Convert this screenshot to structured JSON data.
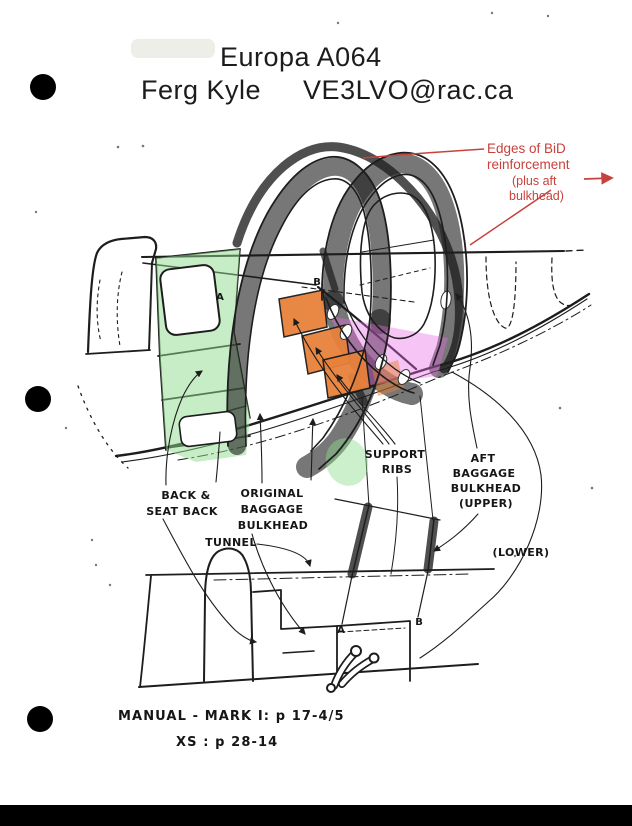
{
  "header": {
    "title": "Europa A064",
    "author": "Ferg Kyle",
    "email": "VE3LVO@rac.ca"
  },
  "red_note": {
    "l1": "Edges of BiD",
    "l2": "reinforcement",
    "l3": "(plus aft",
    "l4": "bulkhead)"
  },
  "labels": {
    "back_seat": {
      "l1": "BACK &",
      "l2": "SEAT BACK"
    },
    "original_baggage": {
      "l1": "ORIGINAL",
      "l2": "BAGGAGE",
      "l3": "BULKHEAD"
    },
    "tunnel": "TUNNEL",
    "support_ribs": {
      "l1": "SUPPORT",
      "l2": "RIBS"
    },
    "aft_baggage": {
      "l1": "AFT",
      "l2": "BAGGAGE",
      "l3": "BULKHEAD",
      "l4": "(UPPER)"
    },
    "lower": "(LOWER)",
    "markers": {
      "a_top": "A",
      "b_top": "B",
      "a_bottom": "A",
      "b_bottom": "B"
    }
  },
  "footer": {
    "l1": "MANUAL - MARK I:   p 17-4/5",
    "l2": "XS   :   p 28-14"
  },
  "colors": {
    "bid_red_highlight": "#d94f45",
    "red_annotation_text": "#c7423c",
    "green_highlight": "#8fdc8f",
    "magenta_highlight": "#e86fe6",
    "orange_highlight": "#e8813a",
    "ink": "#1d1d1d"
  }
}
